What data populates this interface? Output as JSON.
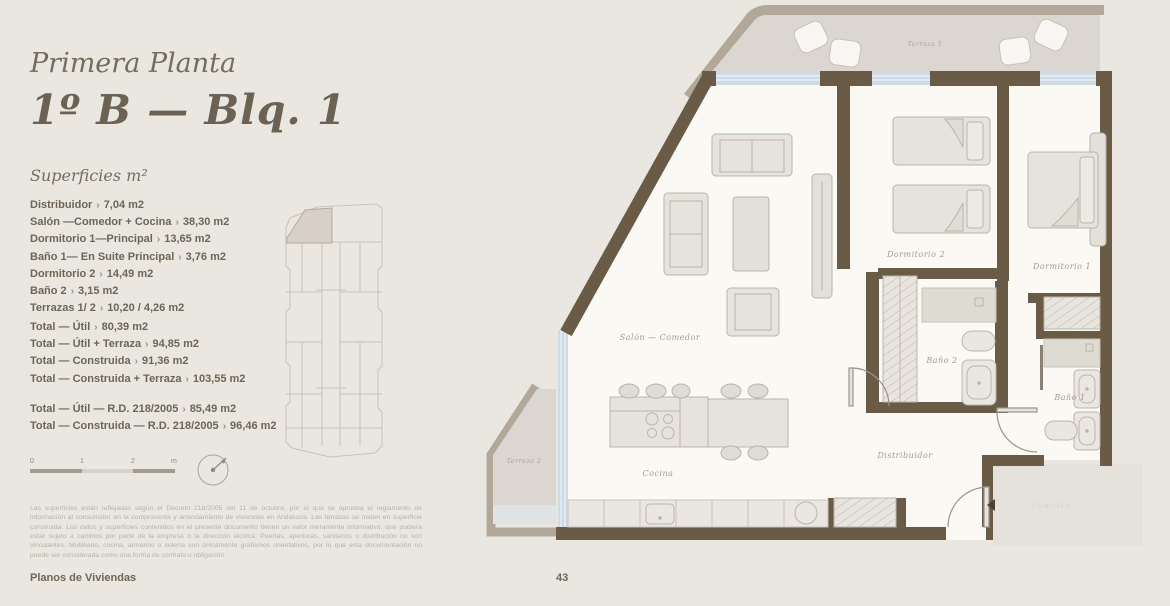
{
  "page": {
    "header": {
      "floor": "Primera Planta",
      "unit": "1º B — Blq. 1",
      "superficies_heading": "Superficies m²"
    },
    "separator_glyph": "›",
    "rooms": [
      {
        "label": "Distribuidor",
        "value": "7,04 m2"
      },
      {
        "label": "Salón —Comedor + Cocina",
        "value": "38,30 m2"
      },
      {
        "label": "Dormitorio 1—Principal",
        "value": "13,65 m2"
      },
      {
        "label": "Baño 1— En Suite Principal",
        "value": "3,76 m2"
      },
      {
        "label": "Dormitorio 2",
        "value": "14,49 m2"
      },
      {
        "label": "Baño 2",
        "value": "3,15 m2"
      },
      {
        "label": "Terrazas 1/ 2",
        "value": "10,20 / 4,26 m2"
      }
    ],
    "totals": [
      {
        "label": "Total — Útil",
        "value": "80,39 m2"
      },
      {
        "label": "Total — Útil + Terraza",
        "value": "94,85 m2"
      },
      {
        "label": "Total — Construida",
        "value": "91,36 m2"
      },
      {
        "label": "Total — Construida + Terraza",
        "value": "103,55 m2"
      }
    ],
    "totals_rd": [
      {
        "label": "Total — Útil — R.D. 218/2005",
        "value": "85,49 m2"
      },
      {
        "label": "Total — Construida — R.D. 218/2005",
        "value": "96,46 m2"
      }
    ],
    "scale": {
      "tick0": "0",
      "tick1": "1",
      "tick2": "2",
      "unit": "m"
    },
    "disclaimer": "Las superficies están reflejadas según el Decreto 218/2005 del 11 de octubre, por el que se aprueba el reglamento de información al consumidor en la compraventa y arrendamiento de viviendas en Andalucía. Las terrazas se miden en superficie construida. Los datos y superficies contenidos en el presente documento tienen un valor meramente informativo, que pudiera estar sujeto a cambios por parte de la empresa o la dirección técnica. Puertas, aperturas, sanitarios o distribución no son vinculantes. Mobiliario, cocina, armarios o solería son únicamente grafismos orientativos, por lo que esta documentación no puede ser considerada como una forma de contrato u obligación.",
    "footer": {
      "section": "Planos de Viviendas",
      "page_number": "43"
    }
  },
  "plan": {
    "labels": {
      "terraza1": "Terraza 1",
      "terraza2": "Terraza 2",
      "salon": "Salón — Comedor",
      "cocina": "Cocina",
      "distribuidor": "Distribuidor",
      "dormitorio1": "Dormitorio 1",
      "dormitorio2": "Dormitorio 2",
      "bano1": "Baño 1",
      "bano2": "Baño 2",
      "common_area": "COMUNES"
    }
  },
  "colors": {
    "background": "#e9e7e0",
    "wall": "#6a5b46",
    "terrace_band": "#b2a89a",
    "terrace_floor": "#dbd7d0",
    "apartment_floor": "#faf9f4",
    "window_glazing": "#cfdae7",
    "furniture_fill": "#e6e3dc",
    "keyplan_highlight": "#d8d0c7",
    "text_dark": "#6e6557"
  }
}
